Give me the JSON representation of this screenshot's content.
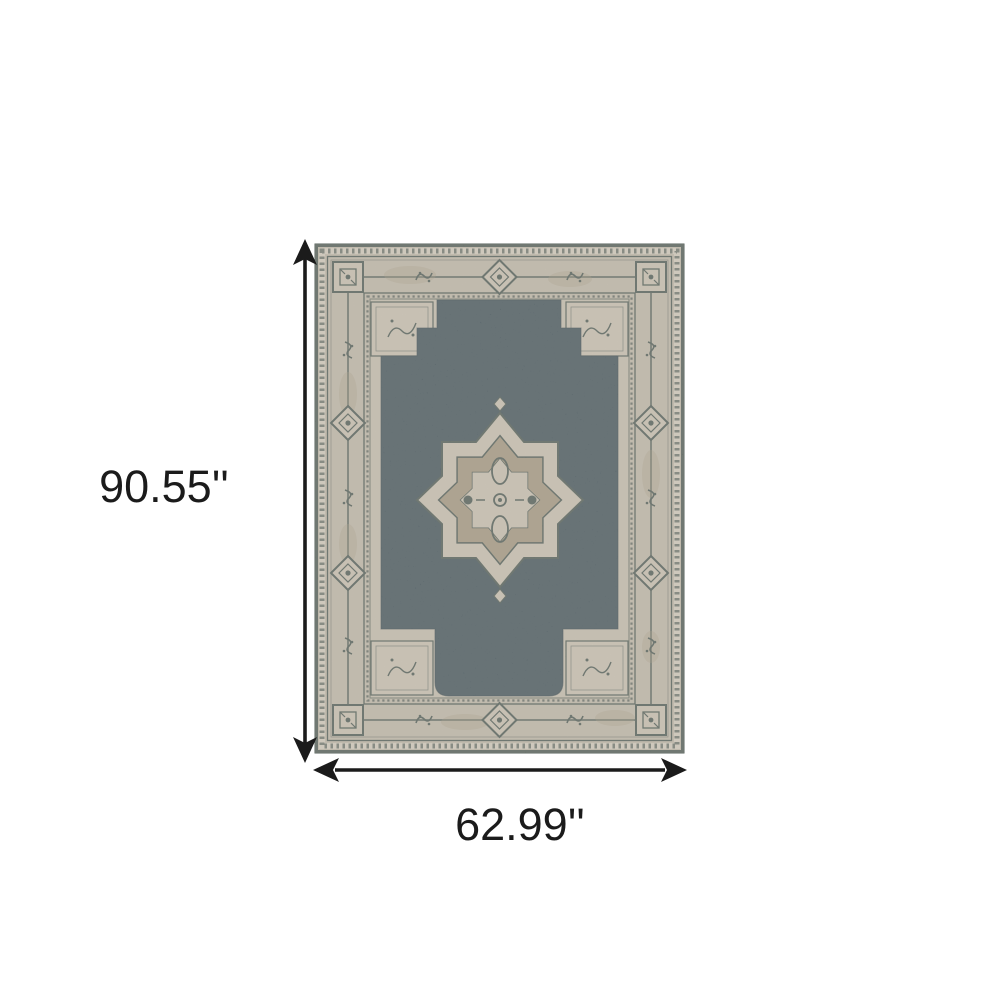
{
  "image": {
    "kind": "product dimension illustration",
    "subject": "oriental medallion area rug with dark slate-blue stepped field, beige distressed ornamental border and central star medallion",
    "background": "#ffffff"
  },
  "dimensions": {
    "height_label": "90.55''",
    "width_label": "62.99''",
    "unit": "inches"
  },
  "icons": {
    "height_arrow": "double-headed-vertical-arrow-icon",
    "width_arrow": "double-headed-horizontal-arrow-icon"
  },
  "colors": {
    "page_bg": "#ffffff",
    "annotation": "#1b1b1b",
    "rug_field": "#4b5a61",
    "rug_beige": "#c6bdae",
    "rug_beige_light": "#cfc6b6",
    "rug_tan": "#ab9e87",
    "rug_dark": "#57625b"
  }
}
